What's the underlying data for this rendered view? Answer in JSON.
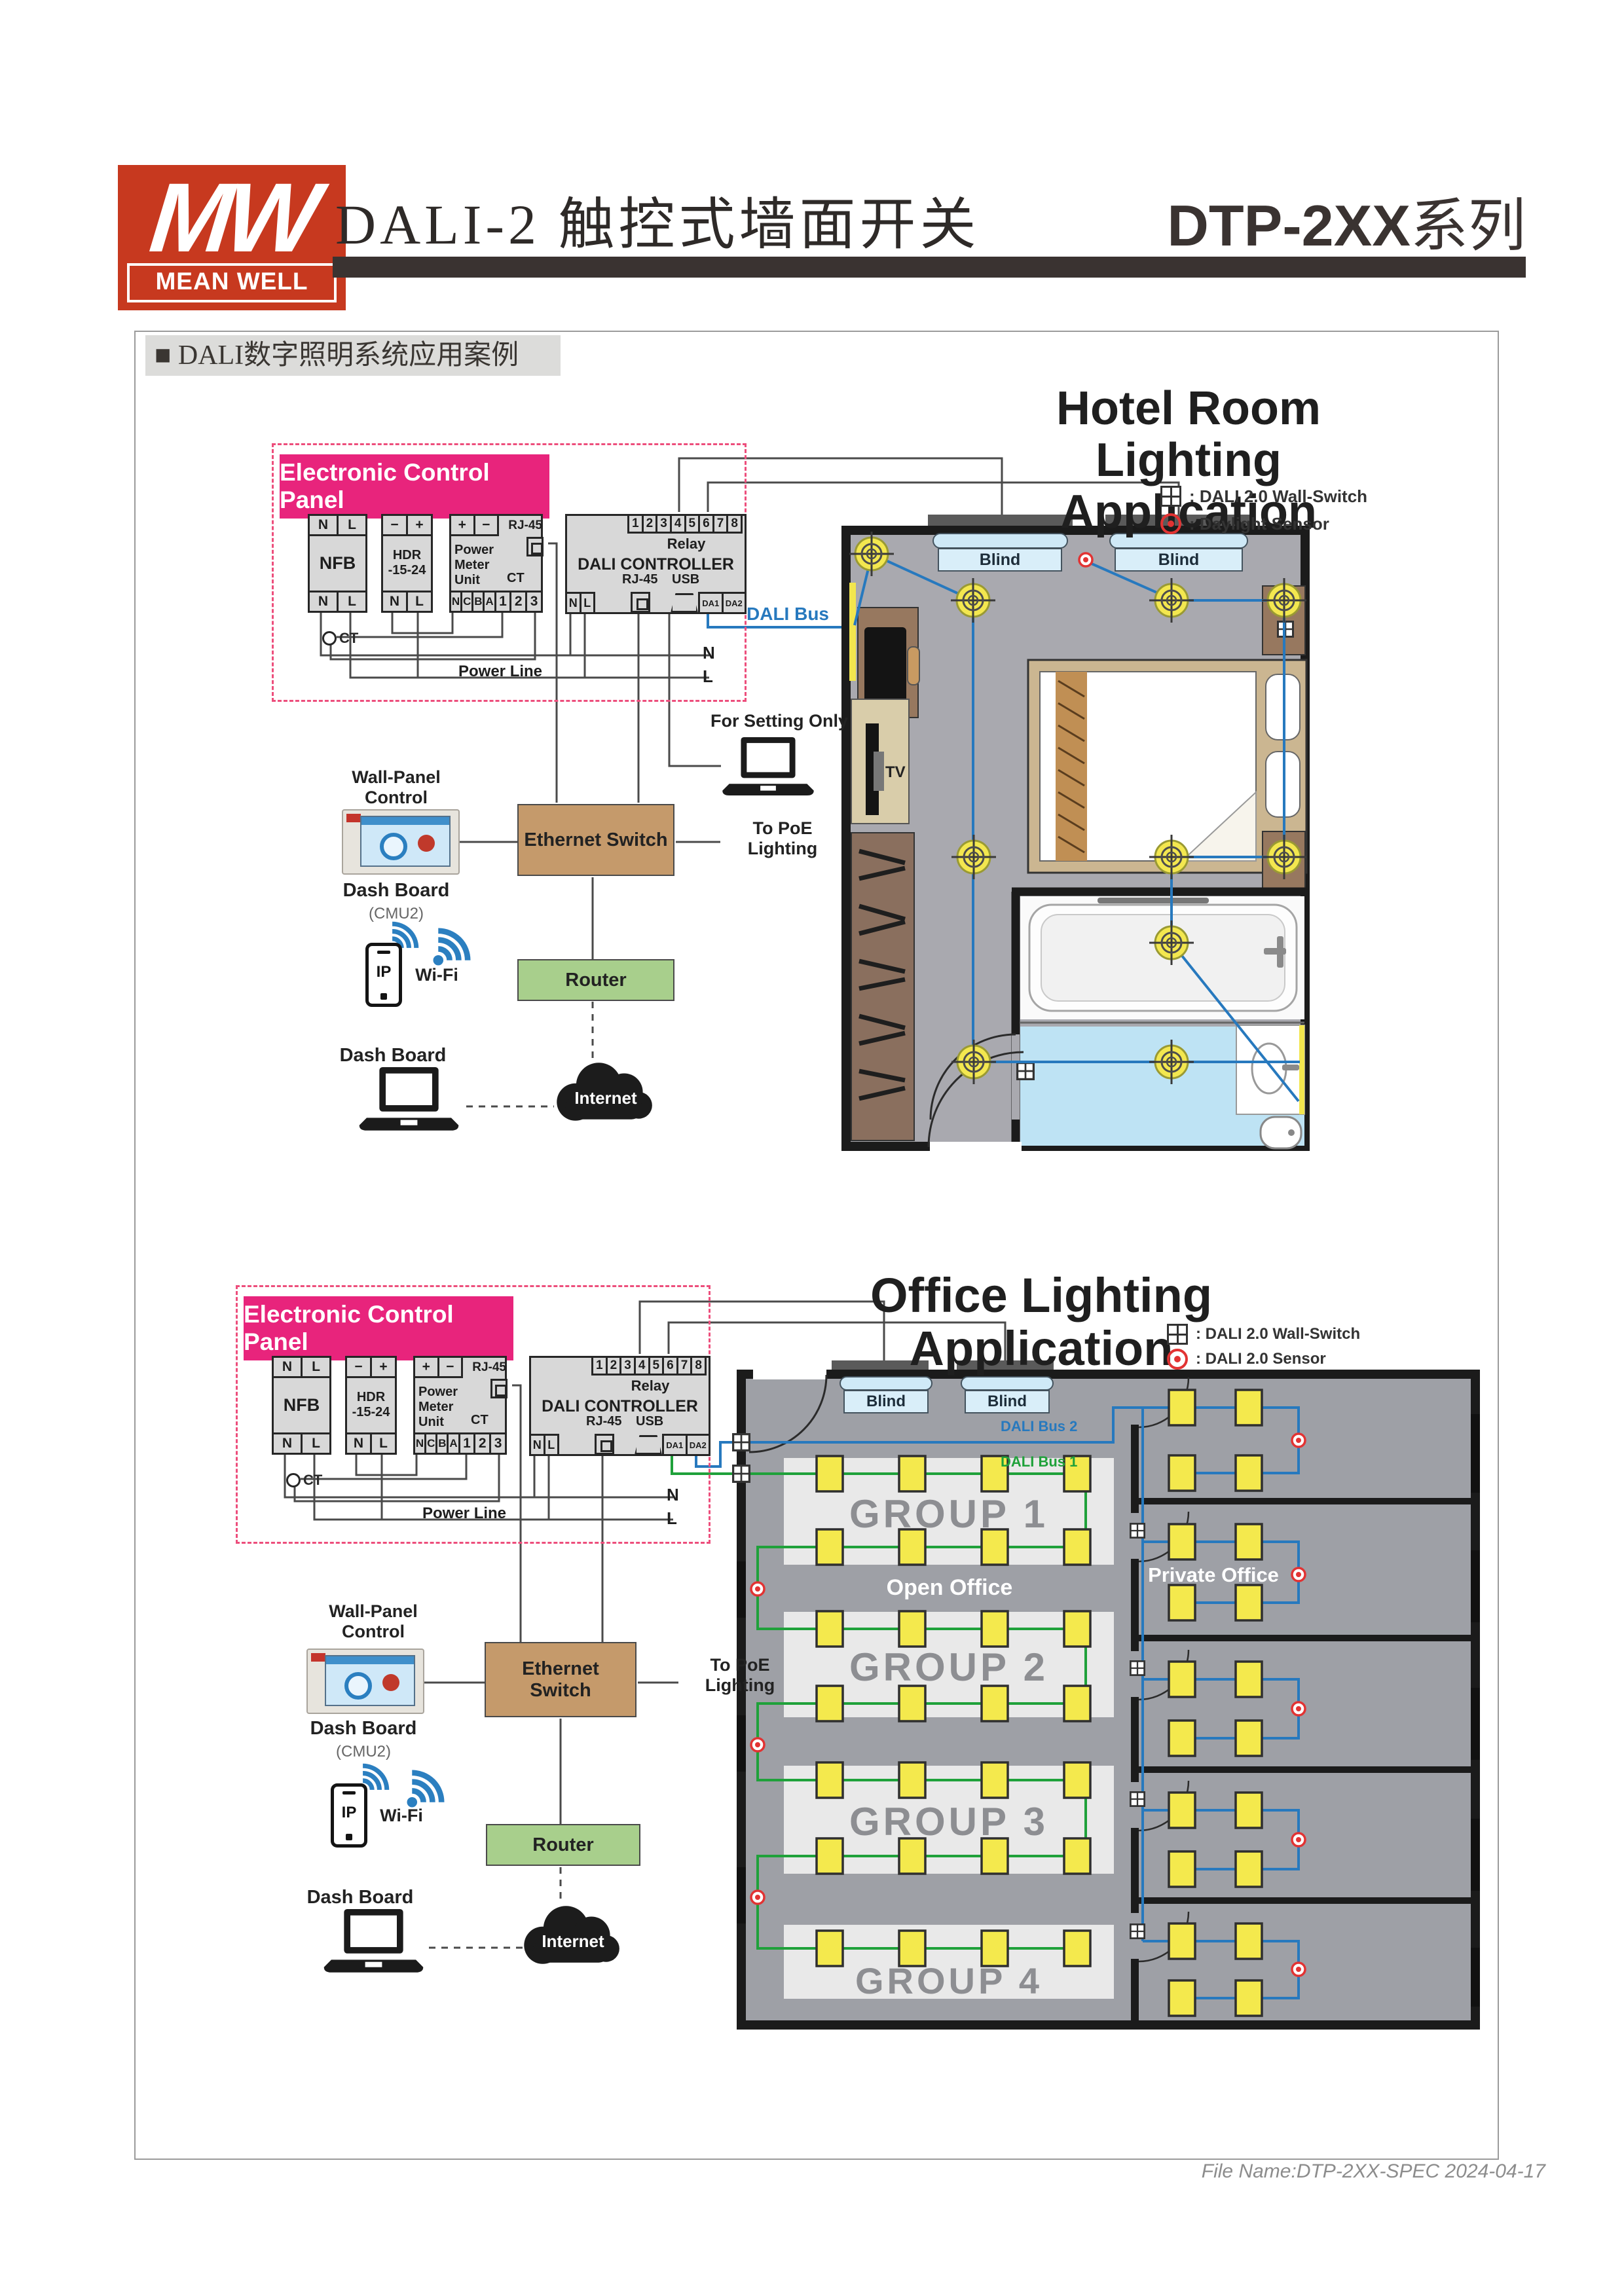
{
  "header": {
    "logo_mw": "MW",
    "logo_brand": "MEAN WELL",
    "product_title": "DALI-2 触控式墙面开关",
    "series_title": "DTP-2XX",
    "series_suffix": "系列"
  },
  "section_title": "■ DALI数字照明系统应用案例",
  "control_panel": {
    "title": "Electronic Control Panel",
    "nfb": {
      "label": "NFB",
      "top": [
        "N",
        "L"
      ],
      "bottom": [
        "N",
        "L"
      ]
    },
    "hdr": {
      "line1": "HDR",
      "line2": "-15-24",
      "top": [
        "−",
        "+"
      ],
      "bottom": [
        "N",
        "L"
      ]
    },
    "pmu": {
      "label": "Power Meter Unit",
      "rj45": "RJ-45",
      "ct": "CT",
      "top": [
        "+",
        "−"
      ],
      "bottom": [
        "N",
        "C",
        "B",
        "A",
        "1",
        "2",
        "3"
      ]
    },
    "dali": {
      "label": "DALI CONTROLLER",
      "relay": "Relay",
      "relay_terminals": [
        "1",
        "2",
        "3",
        "4",
        "5",
        "6",
        "7",
        "8"
      ],
      "rj45": "RJ-45",
      "usb": "USB",
      "bottom": [
        "N",
        "L"
      ],
      "da": [
        "DA1",
        "DA2"
      ]
    },
    "ct_tap": "CT",
    "power_line": "Power Line",
    "neutral": "N",
    "line": "L"
  },
  "hotel": {
    "title1": "Hotel Room",
    "title2": "Lighting Application",
    "legend": [
      {
        "label": ": DALI 2.0 Wall-Switch"
      },
      {
        "label": ": Daylight Sensor"
      }
    ],
    "dali_bus": "DALI Bus",
    "for_setting": "For Setting Only",
    "wall_panel": "Wall-Panel Control",
    "dash_board": "Dash Board",
    "cmu": "(CMU2)",
    "ethernet_switch": "Ethernet Switch",
    "to_poe": "To PoE Lighting",
    "ip": "IP",
    "wifi": "Wi-Fi",
    "router": "Router",
    "dash_board2": "Dash Board",
    "internet": "Internet",
    "blinds": [
      "Blind",
      "Blind"
    ],
    "tv": "TV"
  },
  "office": {
    "title": "Office Lighting Application",
    "legend": [
      {
        "label": ": DALI 2.0 Wall-Switch"
      },
      {
        "label": ": DALI 2.0 Sensor"
      }
    ],
    "bus1": "DALI Bus 1",
    "bus2": "DALI Bus 2",
    "groups": [
      "GROUP 1",
      "GROUP 2",
      "GROUP 3",
      "GROUP 4"
    ],
    "open_office": "Open Office",
    "private_office": "Private Office",
    "blinds": [
      "Blind",
      "Blind"
    ],
    "wall_panel": "Wall-Panel Control",
    "dash_board": "Dash Board",
    "cmu": "(CMU2)",
    "ethernet_switch": "Ethernet Switch",
    "to_poe": "To PoE Lighting",
    "ip": "IP",
    "wifi": "Wi-Fi",
    "router": "Router",
    "dash_board2": "Dash Board",
    "internet": "Internet"
  },
  "footer": {
    "text": "File Name:DTP-2XX-SPEC  2024-04-17"
  }
}
